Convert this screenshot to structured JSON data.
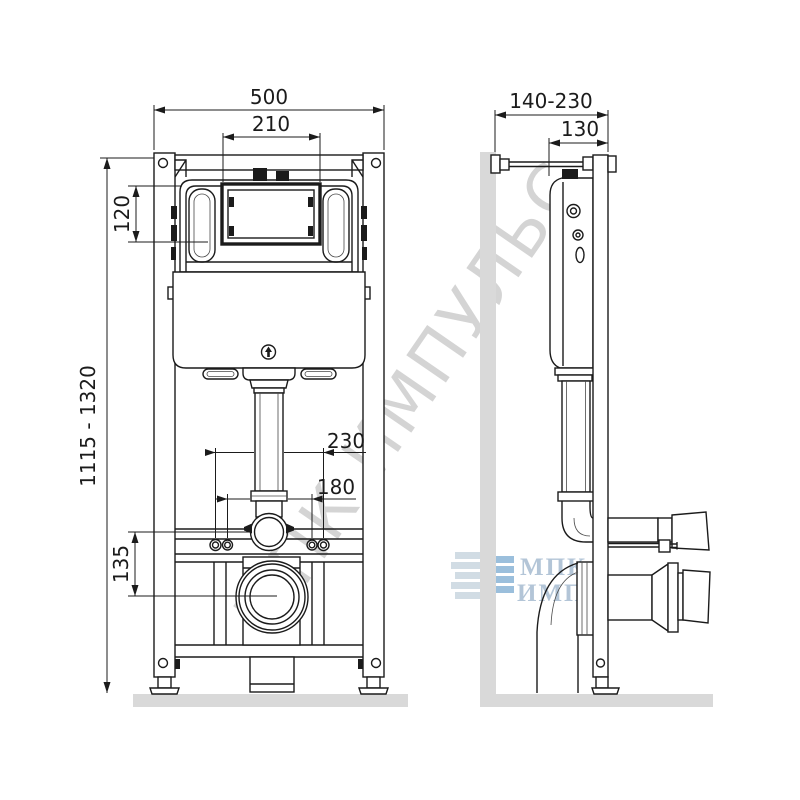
{
  "drawing": {
    "front_view": {
      "dim_total_width": "500",
      "dim_panel_width": "210",
      "dim_panel_height": "120",
      "dim_install_height": "1115 - 1320",
      "dim_bolt_outer": "230",
      "dim_bolt_inner": "180",
      "dim_outlet_offset": "135"
    },
    "side_view": {
      "dim_wall_depth": "140-230",
      "dim_frame_depth": "130"
    }
  },
  "watermark": {
    "diagonal_text": "МПК ИМПУЛЬС",
    "logo_line1": "МПК",
    "logo_line2": "ИМПУЛЬС",
    "logo_icon": "building-blocks-icon"
  },
  "colors": {
    "line": "#1b1b1b",
    "surface_gray": "#d9d9d9",
    "watermark_gray": "rgba(125,125,125,0.33)",
    "logo_blue": "#8ab4d6",
    "logo_light": "#c9d6e0",
    "logo_text": "rgba(150,175,200,0.72)"
  }
}
